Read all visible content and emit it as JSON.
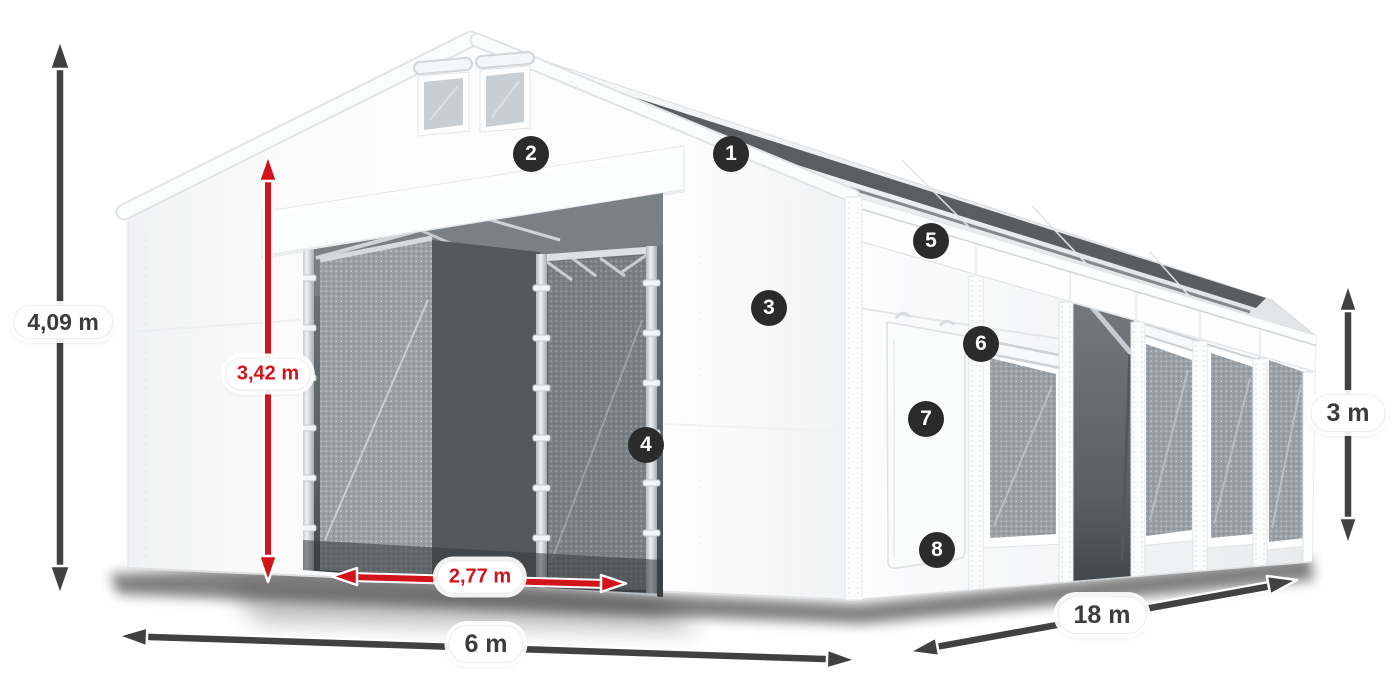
{
  "page": {
    "background_color": "#ffffff"
  },
  "diagram": {
    "description": "Storage tent dimension diagram with numbered part markers",
    "colors": {
      "page_bg": "#ffffff",
      "dimension_arrow": "#414141",
      "dimension_accent": "#d01419",
      "marker_background": "#2b2b2b",
      "marker_text": "#ffffff",
      "label_text": "#3c3c3c",
      "label_background": "#ffffff"
    },
    "dimension_labels": {
      "total_height": "4,09 m",
      "entrance_height": "3,42 m",
      "entrance_width": "2,77 m",
      "tent_width": "6 m",
      "tent_length": "18 m",
      "side_height": "3 m"
    },
    "part_markers": [
      {
        "number": "1"
      },
      {
        "number": "2"
      },
      {
        "number": "3"
      },
      {
        "number": "4"
      },
      {
        "number": "5"
      },
      {
        "number": "6"
      },
      {
        "number": "7"
      },
      {
        "number": "8"
      }
    ]
  }
}
